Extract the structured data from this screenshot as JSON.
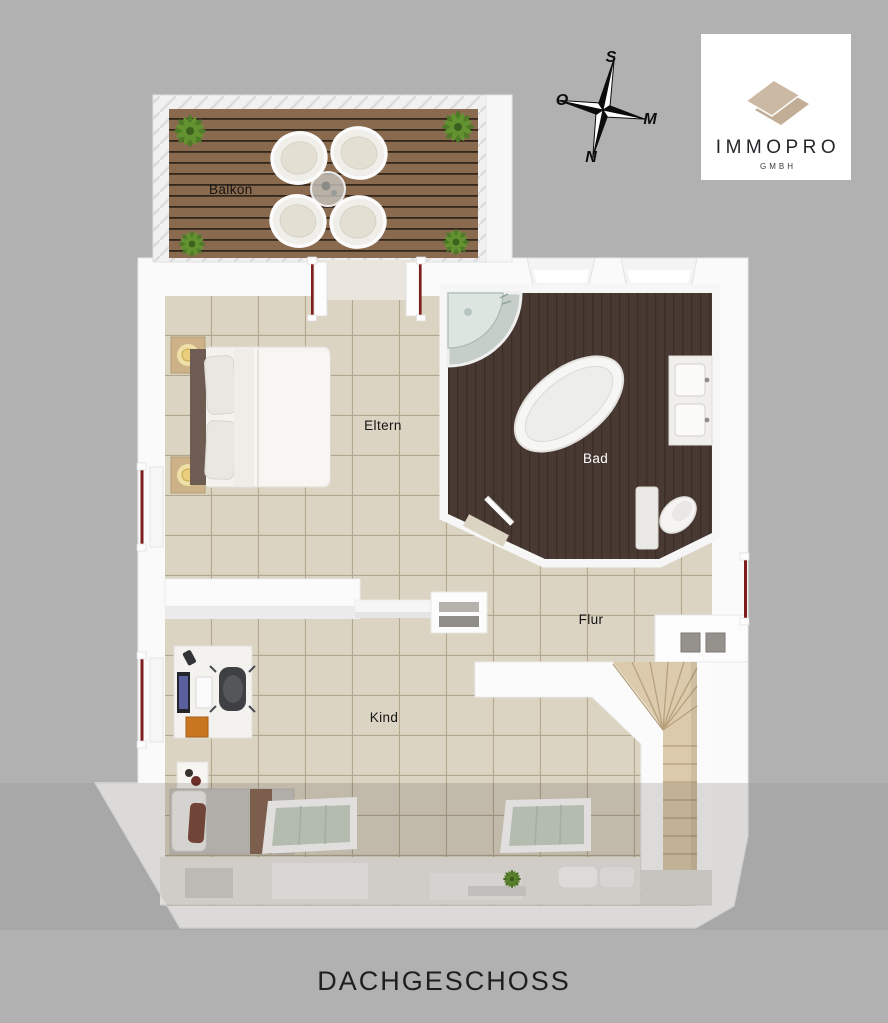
{
  "page": {
    "title": "DACHGESCHOSS",
    "background": "#b1b1b1"
  },
  "logo": {
    "brand": "IMMOPRO",
    "suffix": "GMBH"
  },
  "compass": {
    "top": "S",
    "left": "O",
    "right": "M",
    "bottom": "N"
  },
  "rooms": {
    "balkon": {
      "label": "Balkon"
    },
    "eltern": {
      "label": "Eltern"
    },
    "bad": {
      "label": "Bad"
    },
    "flur": {
      "label": "Flur"
    },
    "kind": {
      "label": "Kind"
    }
  },
  "colors": {
    "background": "#b1b1b1",
    "wall": "#fafafa",
    "tile_floor": "#dcd4c2",
    "tile_grid": "#b3a78e",
    "bath_floor": "#483a32",
    "balcony_deck": "#8a6a4e",
    "stairs_wood": "#dbcaac",
    "window_accent": "#7e1d1d",
    "logo_roof": "#cbb9a3",
    "skylight_glass": "#ccd6c9",
    "plant_green": "#55832a"
  }
}
